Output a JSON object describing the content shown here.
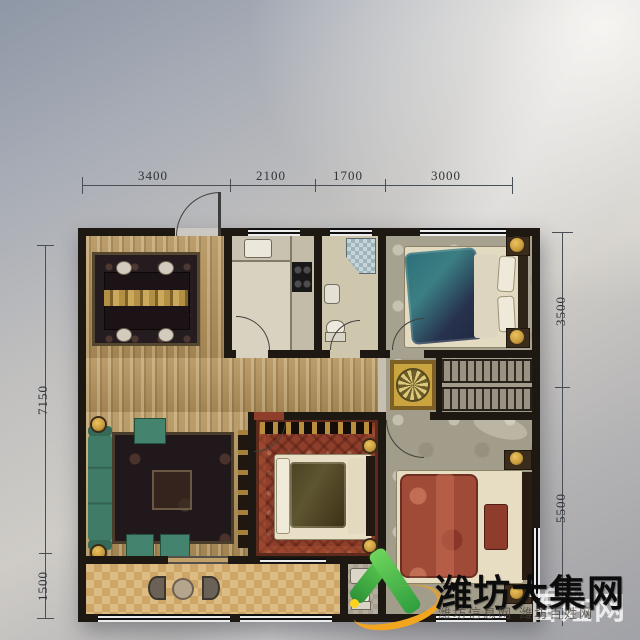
{
  "scene": {
    "type": "photographed residential floor plan",
    "background_tint": "#aeb2b8"
  },
  "dimensions": {
    "top": [
      "3400",
      "2100",
      "1700",
      "3000"
    ],
    "left": [
      "7150",
      "1500"
    ],
    "right": [
      "3500",
      "5500"
    ]
  },
  "watermark": {
    "main": "潍坊大集网",
    "overlay": "百姓网",
    "caption": "潍坊信息网 潍坊百姓网",
    "badge": "H",
    "logo_green": "#35a23c",
    "logo_orange": "#f2a51e"
  },
  "colors": {
    "wall": "#1e1813",
    "wood_floor": "#b4935c",
    "carpet_red": "#8e3e2b",
    "sofa_teal": "#3f7b66",
    "bed_teal": "#2e6f78",
    "bed_red": "#a04a38",
    "medallion_gold": "#caa53f",
    "dim_line": "#4a4e55"
  },
  "icons": [
    "entry-door-arc",
    "window-hatch",
    "dining-table",
    "dining-chair",
    "kitchen-sink",
    "stove-burners",
    "shower-corner",
    "toilet",
    "washbasin",
    "double-bed",
    "pillow",
    "nightstand",
    "table-lamp",
    "wardrobe-hangers",
    "medallion-rug",
    "sofa",
    "ottoman",
    "coffee-table",
    "tv-console",
    "balcony-table",
    "balcony-chair",
    "v-check-logo",
    "swoosh"
  ]
}
